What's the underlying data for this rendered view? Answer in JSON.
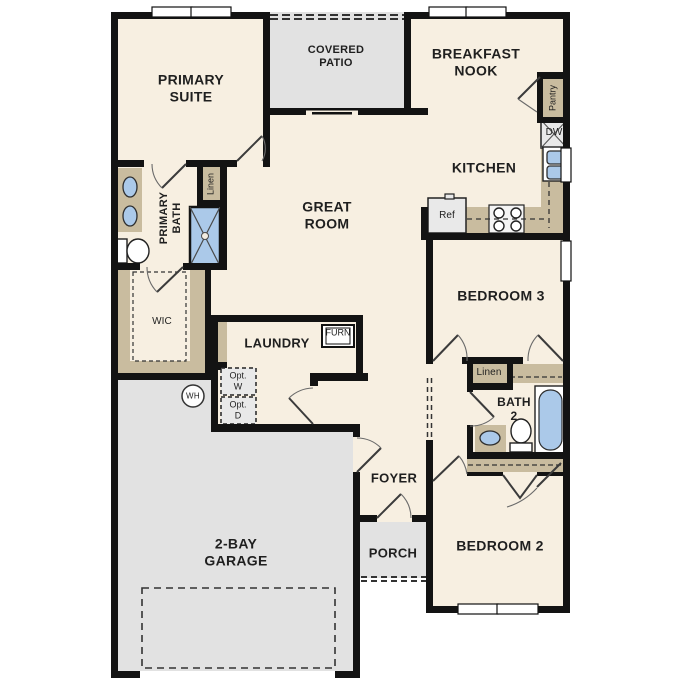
{
  "title": "Single-story floor plan",
  "rooms": {
    "primary_suite": "PRIMARY\nSUITE",
    "covered_patio": "COVERED\nPATIO",
    "breakfast_nook": "BREAKFAST\nNOOK",
    "kitchen": "KITCHEN",
    "great_room": "GREAT\nROOM",
    "primary_bath": "PRIMARY\nBATH",
    "wic": "WIC",
    "laundry": "LAUNDRY",
    "bedroom3": "BEDROOM 3",
    "bath2": "BATH\n2",
    "bedroom2": "BEDROOM 2",
    "foyer": "FOYER",
    "porch": "PORCH",
    "garage": "2-BAY\nGARAGE"
  },
  "fixtures": {
    "linen_primary": "Linen",
    "linen_bath2": "Linen",
    "pantry": "Pantry",
    "dishwasher": "DW",
    "refrigerator": "Ref",
    "furnace": "FURN",
    "opt_washer": "Opt.\nW",
    "opt_dryer": "Opt.\nD",
    "water_heater": "WH"
  },
  "colors": {
    "wall": "#131313",
    "room": "#f7efe1",
    "outdoor": "#e2e2e2",
    "cabinet": "#c9bc9f",
    "fixture_blue": "#abc9e9",
    "appliance": "#e9e9e9",
    "text": "#1f1f1f",
    "dash": "#333333"
  }
}
